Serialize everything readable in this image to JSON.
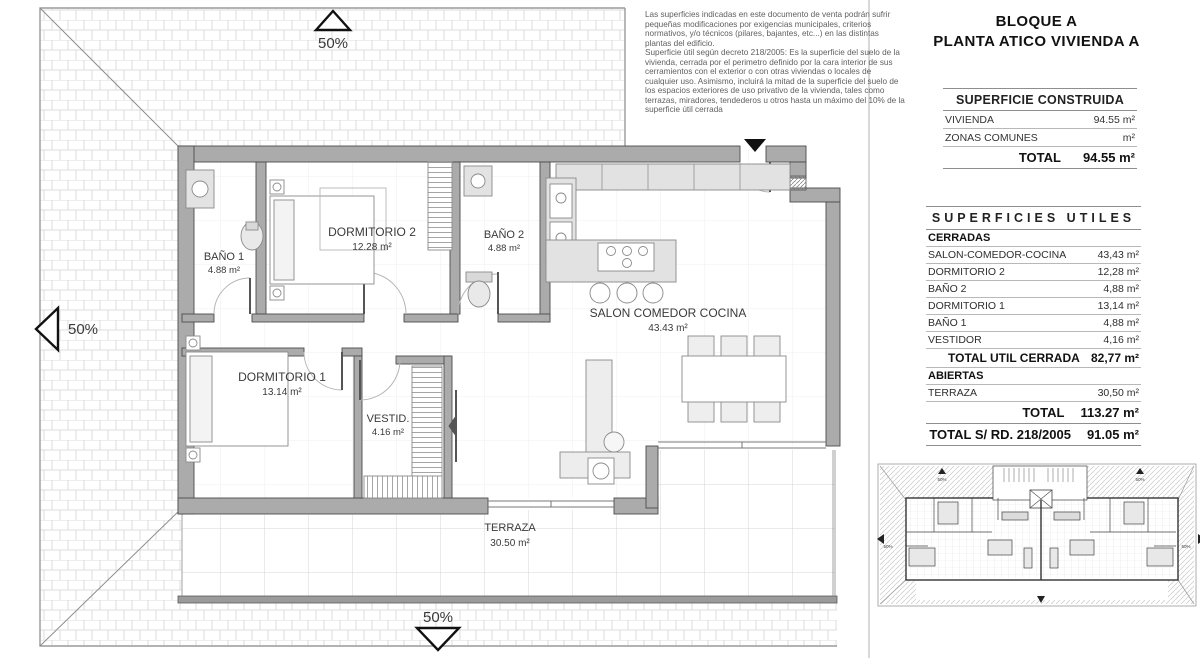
{
  "header": {
    "title_line1": "BLOQUE A",
    "title_line2": "PLANTA ATICO VIVIENDA A"
  },
  "disclaimer": {
    "lines": [
      "Las superficies indicadas en este documento de venta podrán sufrir",
      "pequeñas modificaciones por exigencias municipales, criterios",
      "normativos, y/o técnicos (pilares, bajantes, etc...) en las distintas",
      "plantas del edificio.",
      "Superficie útil según decreto 218/2005: Es la superficie del suelo de la",
      "vivienda, cerrada por el perimetro definido por la cara interior de sus",
      "cerramientos con el exterior o con otras viviendas o locales de",
      "cualquier uso. Asimismo, incluirá la mitad de la superficie del suelo de",
      "los espacios exteriores de uso privativo de la vivienda, tales como",
      "terrazas, miradores, tendederos u otros hasta un máximo del 10% de la",
      "superficie útil cerrada"
    ]
  },
  "superficie_construida": {
    "title": "SUPERFICIE CONSTRUIDA",
    "rows": [
      {
        "label": "VIVIENDA",
        "value": "94.55 m²"
      },
      {
        "label": "ZONAS COMUNES",
        "value": "m²"
      }
    ],
    "total": {
      "label": "TOTAL",
      "value": "94.55 m²"
    }
  },
  "superficies_utiles": {
    "title": "SUPERFICIES UTILES",
    "rows": [
      {
        "label": "CERRADAS",
        "value": "",
        "style": "section"
      },
      {
        "label": "SALON-COMEDOR-COCINA",
        "value": "43,43 m²",
        "style": "row"
      },
      {
        "label": "DORMITORIO 2",
        "value": "12,28 m²",
        "style": "row"
      },
      {
        "label": "BAÑO 2",
        "value": "4,88 m²",
        "style": "row"
      },
      {
        "label": "DORMITORIO 1",
        "value": "13,14 m²",
        "style": "row"
      },
      {
        "label": "BAÑO 1",
        "value": "4,88 m²",
        "style": "row"
      },
      {
        "label": "VESTIDOR",
        "value": "4,16 m²",
        "style": "row"
      },
      {
        "label": "TOTAL UTIL CERRADA",
        "value": "82,77 m²",
        "style": "total"
      },
      {
        "label": "ABIERTAS",
        "value": "",
        "style": "section"
      },
      {
        "label": "TERRAZA",
        "value": "30,50 m²",
        "style": "row"
      },
      {
        "label": "TOTAL",
        "value": "113.27 m²",
        "style": "grand"
      },
      {
        "label": "TOTAL S/ RD. 218/2005",
        "value": "91.05 m²",
        "style": "grand"
      }
    ]
  },
  "plan": {
    "rooms": [
      {
        "name": "BAÑO 1",
        "area": "4.88 m²"
      },
      {
        "name": "DORMITORIO 2",
        "area": "12.28 m²"
      },
      {
        "name": "BAÑO 2",
        "area": "4.88 m²"
      },
      {
        "name": "SALON COMEDOR COCINA",
        "area": "43.43 m²"
      },
      {
        "name": "DORMITORIO 1",
        "area": "13.14 m²"
      },
      {
        "name": "VESTID.",
        "area": "4.16 m²"
      },
      {
        "name": "TERRAZA",
        "area": "30.50 m²"
      }
    ],
    "slope_labels": {
      "top": "50%",
      "left": "50%",
      "bottom": "50%"
    }
  },
  "inset": {
    "slope_label": "50%"
  }
}
